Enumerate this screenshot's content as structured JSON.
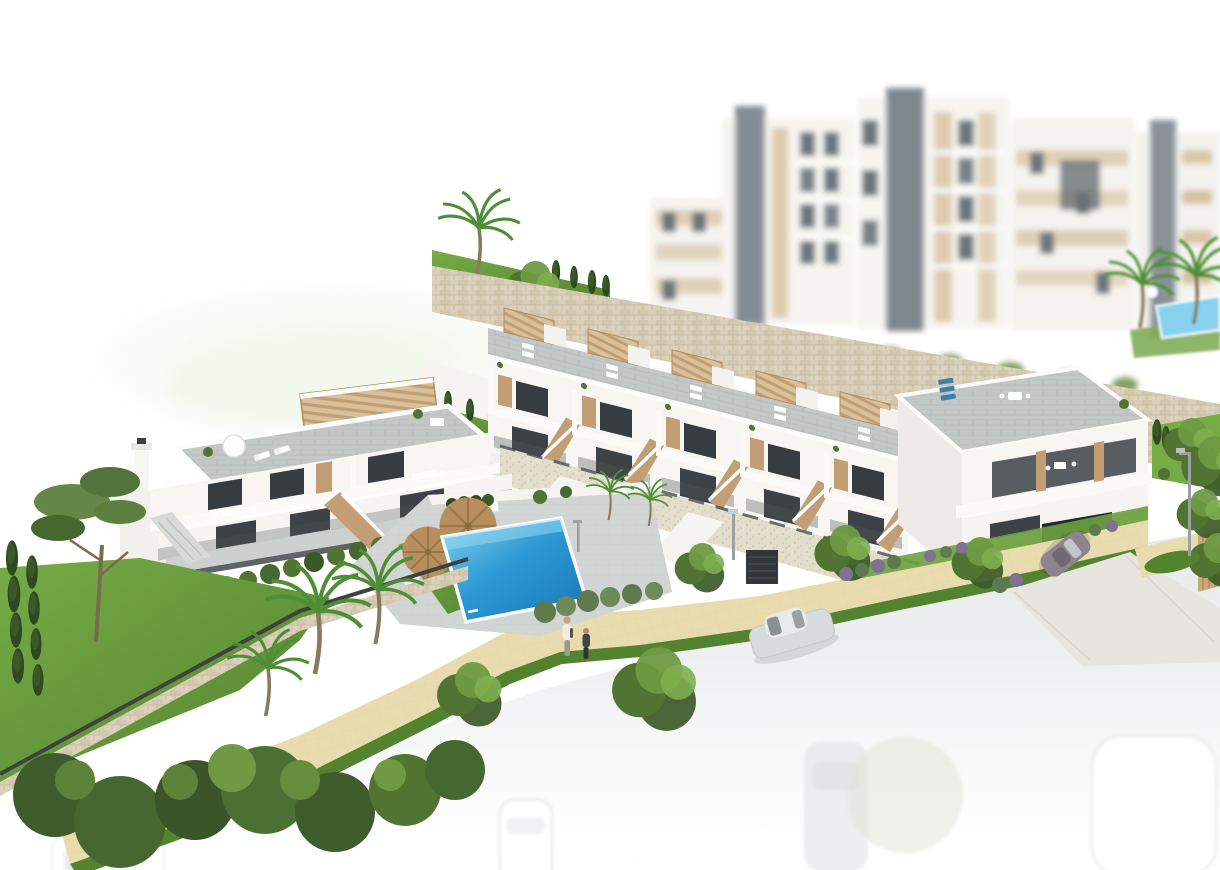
{
  "image": {
    "kind": "3d-architectural-rendering",
    "subject": "Aerial 3D render of a hillside residential development: rows of white townhouses with roof terraces and tan pergolas, a communal pool with sun loungers, landscaped gardens, a sand-coloured walkway, a street fading to white with parked cars, and blurred apartment blocks behind a stone retaining wall",
    "visible_text": "none"
  },
  "colors": {
    "background": "#ffffff",
    "hill_green": "#edf4e3",
    "wall_white": "#f7f6f3",
    "wall_shadow": "#ecebe7",
    "roof_paver": "#c3c8c6",
    "roof_paver_dark": "#aeb4b2",
    "window_dark": "#363c40",
    "glass_lower": "#3d4246",
    "timber_tan": "#c29e74",
    "timber_dark": "#b08c5f",
    "stone_wall": "#d9cfb9",
    "stone_line": "#c4b79d",
    "pebble_wall": "#e3ddcb",
    "grass_bright": "#76ab46",
    "grass_dark": "#54832f",
    "tree_dark": "#3c5a28",
    "tree_mid": "#527433",
    "tree_light": "#6f9a43",
    "shrub_purple": "#7e7290",
    "pool_blue": "#2d9ad4",
    "pool_blue_deep": "#1877b8",
    "pool_blue_light": "#86d2ef",
    "path_beige": "#e8dcae",
    "path_line": "#d9cb97",
    "road_gray": "#e7e9ea",
    "driveway_gray": "#e7e5e0",
    "car_silver": "#d8dbdd",
    "car_dark": "#8d8490",
    "metal_gray": "#9aa0a3",
    "fence_dark": "#3e4140",
    "umbrella_tan": "#b78f5e",
    "lounger_blue": "#3f7fae"
  },
  "scene": {
    "background_hill": "faded green hillside haze",
    "background_apartments": "blurred white apartment blocks with beige panels and dark elevator cores",
    "background_pool": "small condominium pool with palm trees beside the apartments",
    "upper_retaining_wall": "sandstone retaining wall with planted grass top and palm tree",
    "townhouse_row": "stepped row of five white townhouses with roof terraces, tan pergolas and external staircases",
    "corner_townhouse": "corner block with wide balconies, blue roof loungers and under-build garage",
    "left_villa": "two-storey villa pair with roof solarium, slatted pergola, terraces and tan staircase",
    "communal_pool": "rectangular blue communal swimming pool with white rim, lawn, sun loungers and two tan parasols",
    "gardens": "lawns, pine, palm trees, cypress hedges and shrubs",
    "walkway": "sand-coloured paved pedestrian walkway with grass verge",
    "road": "street fading to white with ghosted parked cars",
    "silver_car": "silver saloon parked on the street",
    "garage_car": "dark sports car on the garage driveway",
    "pedestrians": "adult and child walking on the walkway",
    "street_lamps": "two grey street lamps"
  }
}
